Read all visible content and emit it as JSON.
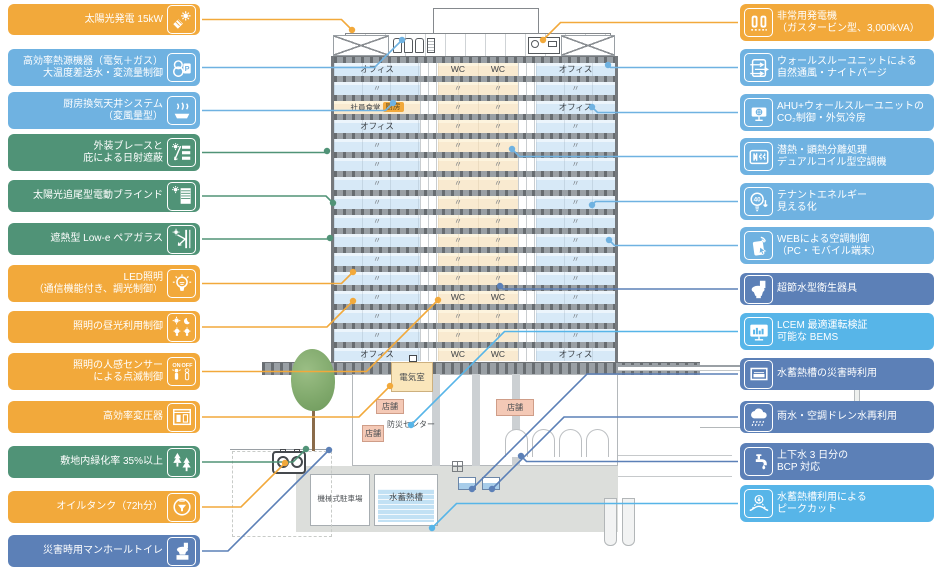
{
  "colors": {
    "orange": "#F2A93B",
    "blue": "#6FB2E1",
    "green": "#509377",
    "steel": "#5C80B7",
    "sky": "#57B5E8"
  },
  "left_labels": [
    {
      "text": "太陽光発電 15kW",
      "color": "orange",
      "icon": "solar-panel-icon"
    },
    {
      "text": "高効率熱源機器（電気＋ガス）\n大温度差送水・変流量制御",
      "color": "blue",
      "icon": "heat-pump-icon"
    },
    {
      "text": "厨房換気天井システム\n（変風量型）",
      "color": "blue",
      "icon": "kitchen-vent-icon"
    },
    {
      "text": "外装ブレースと\n庇による日射遮蔽",
      "color": "green",
      "icon": "brace-shade-icon"
    },
    {
      "text": "太陽光追尾型電動ブラインド",
      "color": "green",
      "icon": "blind-icon"
    },
    {
      "text": "遮熱型 Low-e ペアガラス",
      "color": "green",
      "icon": "low-e-glass-icon"
    },
    {
      "text": "LED照明\n（通信機能付き、調光制御）",
      "color": "orange",
      "icon": "led-bulb-icon"
    },
    {
      "text": "照明の昼光利用制御",
      "color": "orange",
      "icon": "daylight-control-icon"
    },
    {
      "text": "照明の人感センサー\nによる点滅制御",
      "color": "orange",
      "icon": "occupancy-sensor-icon"
    },
    {
      "text": "高効率変圧器",
      "color": "orange",
      "icon": "transformer-icon"
    },
    {
      "text": "敷地内緑化率 35%以上",
      "color": "green",
      "icon": "trees-icon"
    },
    {
      "text": "オイルタンク（72h分）",
      "color": "orange",
      "icon": "oil-tank-icon"
    },
    {
      "text": "災害時用マンホールトイレ",
      "color": "steel",
      "icon": "manhole-toilet-icon"
    }
  ],
  "right_labels": [
    {
      "text": "非常用発電機\n（ガスタービン型、3,000kVA）",
      "color": "orange",
      "icon": "generator-icon"
    },
    {
      "text": "ウォールスルーユニットによる\n自然通風・ナイトパージ",
      "color": "blue",
      "icon": "wall-through-unit-icon"
    },
    {
      "text": "AHU+ウォールスルーユニットの\nCO₂制御・外気冷房",
      "color": "blue",
      "icon": "ahu-icon"
    },
    {
      "text": "潜熱・顕熱分離処理\nデュアルコイル型空調機",
      "color": "blue",
      "icon": "dual-coil-icon"
    },
    {
      "text": "テナントエネルギー\n見える化",
      "color": "blue",
      "icon": "energy-visualization-icon"
    },
    {
      "text": "WEBによる空調制御\n（PC・モバイル端末）",
      "color": "blue",
      "icon": "web-control-icon"
    },
    {
      "text": "超節水型衛生器具",
      "color": "steel",
      "icon": "toilet-icon"
    },
    {
      "text": "LCEM 最適運転検証\n可能な BEMS",
      "color": "sky",
      "icon": "bems-monitor-icon"
    },
    {
      "text": "水蓄熱槽の災害時利用",
      "color": "steel",
      "icon": "storage-tank-icon"
    },
    {
      "text": "雨水・空調ドレン水再利用",
      "color": "steel",
      "icon": "rain-icon"
    },
    {
      "text": "上下水 3 日分の\nBCP 対応",
      "color": "steel",
      "icon": "faucet-icon"
    },
    {
      "text": "水蓄熱槽利用による\nピークカット",
      "color": "sky",
      "icon": "peak-cut-icon"
    }
  ],
  "building": {
    "floors": [
      {
        "l": "オフィス",
        "c1": "WC",
        "c2": "WC",
        "r": "オフィス"
      },
      {
        "l": "〃",
        "c1": "〃",
        "c2": "〃",
        "r": "〃"
      },
      {
        "l": "社員食堂",
        "chip": "厨房",
        "c1": "〃",
        "c2": "〃",
        "r": "オフィス"
      },
      {
        "l": "オフィス",
        "c1": "〃",
        "c2": "〃",
        "r": "〃"
      },
      {
        "l": "〃",
        "c1": "〃",
        "c2": "〃",
        "r": "〃"
      },
      {
        "l": "〃",
        "c1": "〃",
        "c2": "〃",
        "r": "〃"
      },
      {
        "l": "〃",
        "c1": "〃",
        "c2": "〃",
        "r": "〃"
      },
      {
        "l": "〃",
        "c1": "〃",
        "c2": "〃",
        "r": "〃"
      },
      {
        "l": "〃",
        "c1": "〃",
        "c2": "〃",
        "r": "〃"
      },
      {
        "l": "〃",
        "c1": "〃",
        "c2": "〃",
        "r": "〃"
      },
      {
        "l": "〃",
        "c1": "〃",
        "c2": "〃",
        "r": "〃"
      },
      {
        "l": "〃",
        "c1": "〃",
        "c2": "〃",
        "r": "〃"
      },
      {
        "l": "〃",
        "c1": "WC",
        "c2": "WC",
        "r": "〃"
      },
      {
        "l": "〃",
        "c1": "〃",
        "c2": "〃",
        "r": "〃"
      },
      {
        "l": "〃",
        "c1": "〃",
        "c2": "〃",
        "r": "〃"
      },
      {
        "l": "オフィス",
        "c1": "WC",
        "c2": "WC",
        "r": "オフィス"
      }
    ],
    "rooms": {
      "electrical_room": "電気室",
      "shop": "店舗",
      "disaster_center": "防災センター",
      "mech_parking": "機械式駐車場",
      "thermal_tank": "水蓄熱槽"
    }
  }
}
